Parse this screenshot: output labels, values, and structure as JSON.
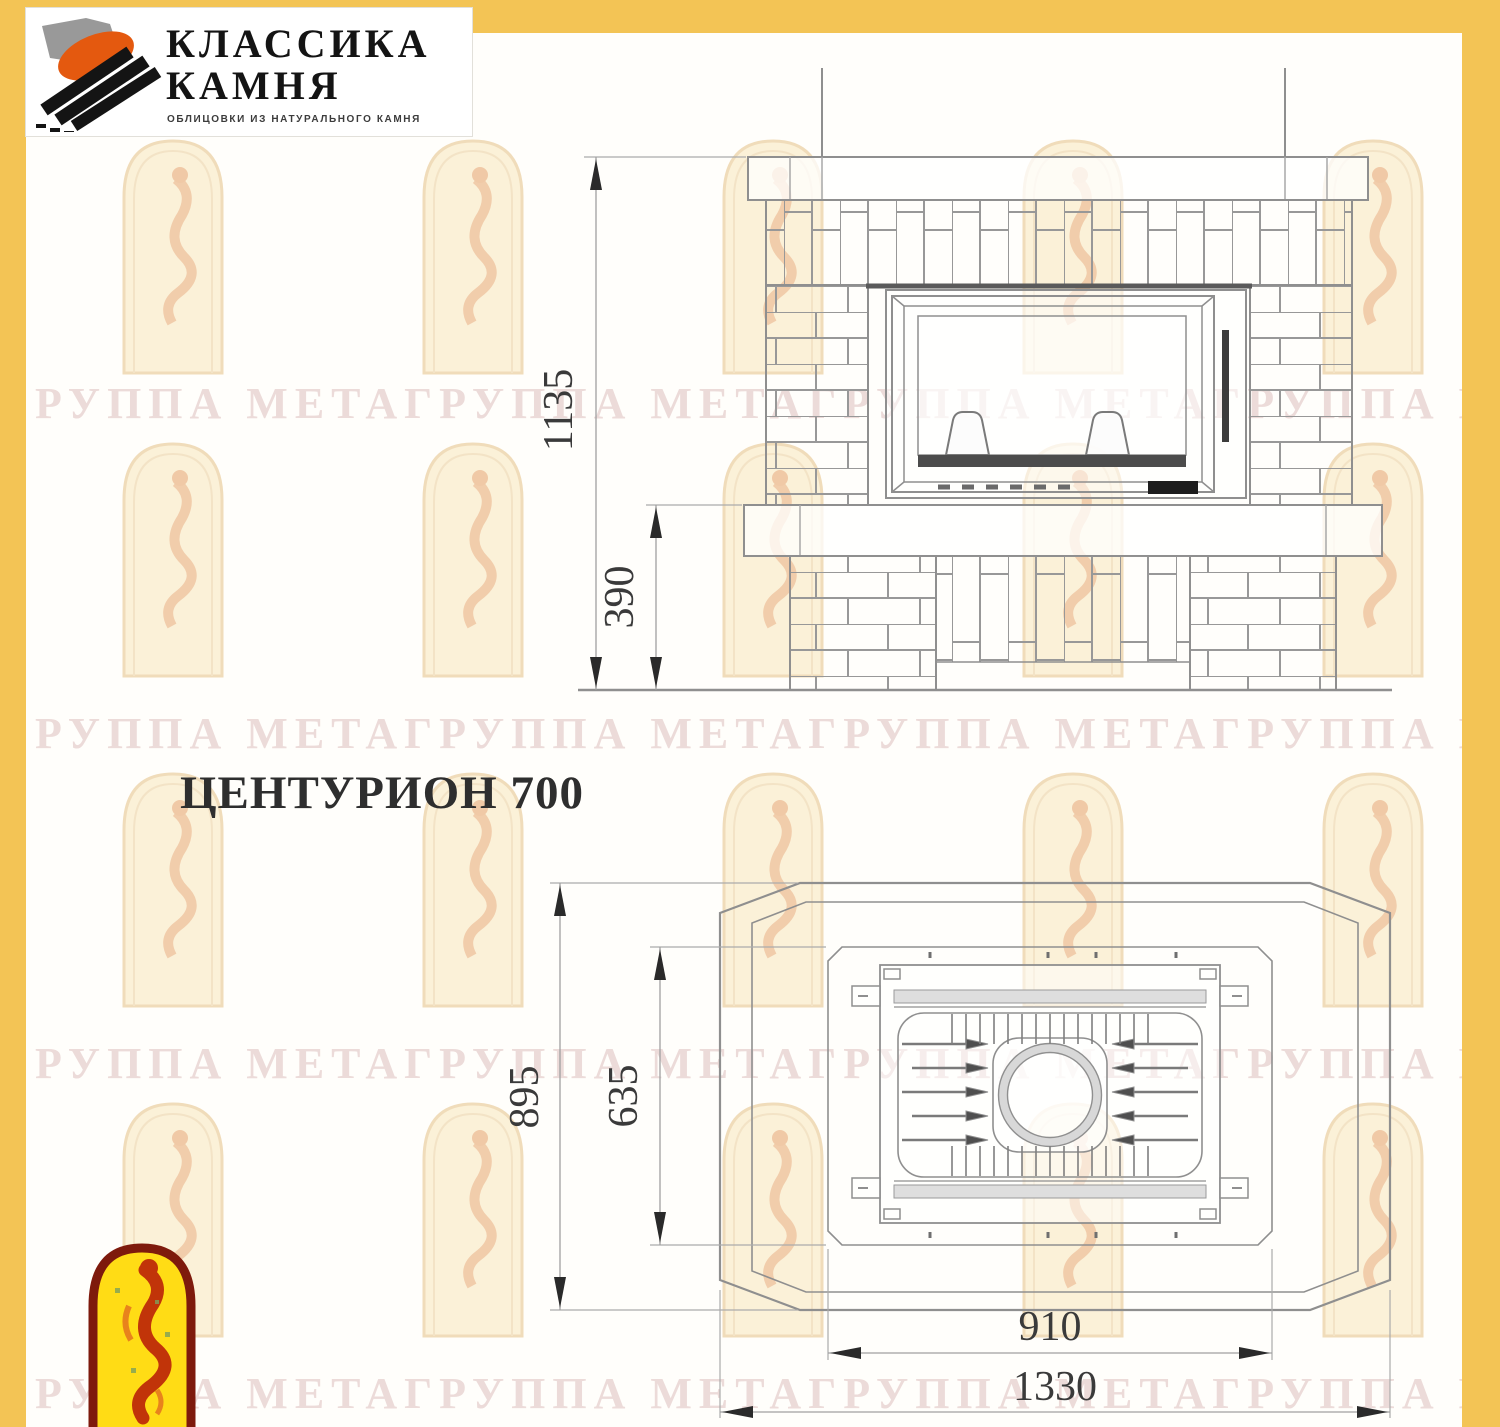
{
  "brand": {
    "line1": "КЛАССИКА",
    "line2": "КАМНЯ",
    "tagline": "ОБЛИЦОВКИ ИЗ НАТУРАЛЬНОГО КАМНЯ"
  },
  "model": {
    "title": "ЦЕНТУРИОН 700"
  },
  "watermark": {
    "text": "ГРУППА МЕТАГРУППА МЕТАГРУППА МЕТАГРУППА МЕТА"
  },
  "drawing": {
    "front": {
      "dim_total_height": "1135",
      "dim_base_height": "390"
    },
    "plan": {
      "dim_total_depth": "895",
      "dim_insert_depth": "635",
      "dim_insert_width": "910",
      "dim_total_width": "1330"
    }
  },
  "colors": {
    "frame_yellow": "#F3C455",
    "logo_orange": "#E4590F",
    "logo_gray": "#8E8E8E",
    "logo_black": "#141414",
    "emblem_border_red": "#7E1A0C",
    "emblem_fill_yellow": "#FFDC15",
    "emblem_figure_red": "#C13409",
    "drawing_line_gray": "#8F8F8F",
    "dimension_text": "#3A3A3A"
  }
}
